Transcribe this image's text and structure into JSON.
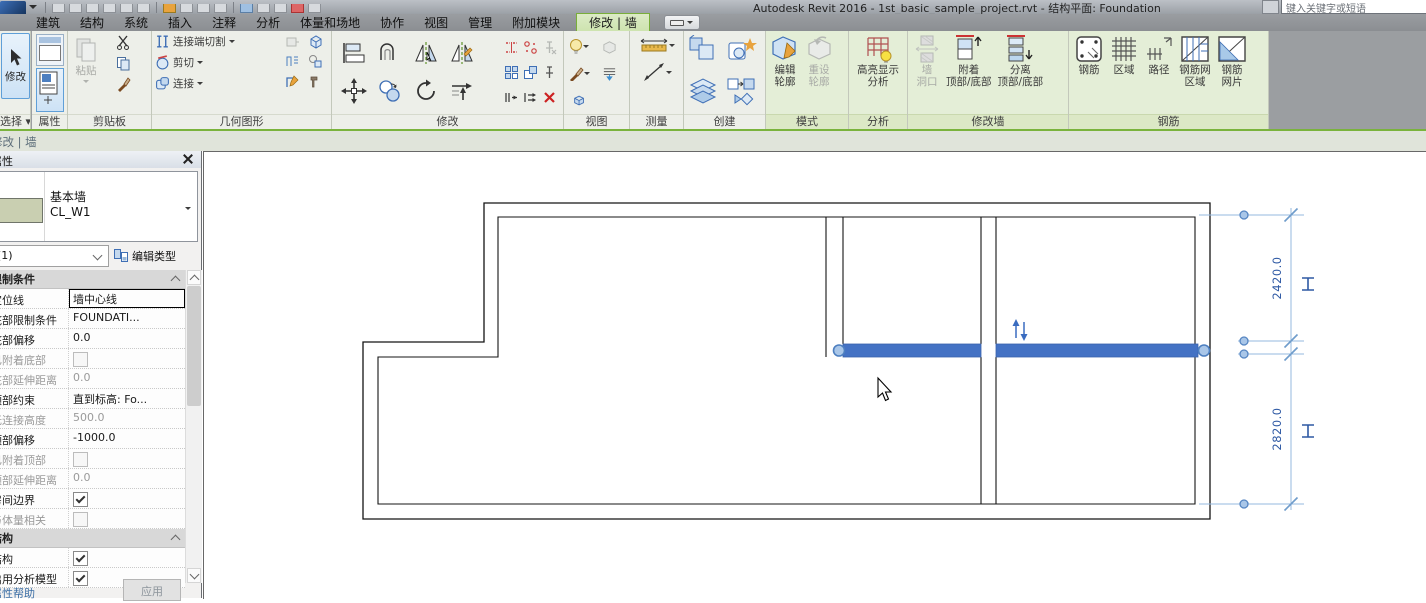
{
  "window": {
    "title": "Autodesk Revit 2016 - 1st_basic_sample_project.rvt - 结构平面: Foundation",
    "search_placeholder": "键入关键字或短语"
  },
  "tabs": {
    "items": [
      "建筑",
      "结构",
      "系统",
      "插入",
      "注释",
      "分析",
      "体量和场地",
      "协作",
      "视图",
      "管理",
      "附加模块"
    ],
    "contextual": "修改 | 墙"
  },
  "ribbon": {
    "panels": {
      "select": {
        "label": "选择",
        "modify": "修改"
      },
      "properties": {
        "label": "属性"
      },
      "clipboard": {
        "label": "剪贴板",
        "paste": "粘贴"
      },
      "geometry": {
        "label": "几何图形",
        "join_cut": "连接端切割",
        "cut": "剪切",
        "join": "连接"
      },
      "modify": {
        "label": "修改"
      },
      "view": {
        "label": "视图"
      },
      "measure": {
        "label": "测量"
      },
      "create": {
        "label": "创建"
      },
      "mode": {
        "label": "模式",
        "edit_profile_1": "编辑",
        "edit_profile_2": "轮廓",
        "reset_profile_1": "重设",
        "reset_profile_2": "轮廓"
      },
      "analysis": {
        "label": "分析",
        "highlight_1": "高亮显示",
        "highlight_2": "分析"
      },
      "modify_wall": {
        "label": "修改墙",
        "opening_1": "墙",
        "opening_2": "洞口",
        "attach_1": "附着",
        "attach_2": "顶部/底部",
        "detach_1": "分离",
        "detach_2": "顶部/底部"
      },
      "rebar": {
        "label": "钢筋",
        "rebar": "钢筋",
        "area": "区域",
        "path": "路径",
        "fabric_area_1": "钢筋网",
        "fabric_area_2": "区域",
        "fabric_sheet_1": "钢筋",
        "fabric_sheet_2": "网片"
      }
    }
  },
  "mode_bar": {
    "text": "修改 | 墙"
  },
  "properties": {
    "header": "属性",
    "type_name": "基本墙",
    "type_code": "CL_W1",
    "selection": "(1)",
    "edit_type": "编辑类型",
    "sections": [
      {
        "title": "限制条件",
        "rows": [
          {
            "label": "定位线",
            "value": "墙中心线",
            "type": "text",
            "enabled": true,
            "active": true
          },
          {
            "label": "底部限制条件",
            "value": "FOUNDATI...",
            "type": "text",
            "enabled": true
          },
          {
            "label": "底部偏移",
            "value": "0.0",
            "type": "text",
            "enabled": true
          },
          {
            "label": "已附着底部",
            "type": "checkbox",
            "checked": false,
            "enabled": false
          },
          {
            "label": "底部延伸距离",
            "value": "0.0",
            "type": "text",
            "enabled": false
          },
          {
            "label": "顶部约束",
            "value": "直到标高: Fo...",
            "type": "text",
            "enabled": true
          },
          {
            "label": "无连接高度",
            "value": "500.0",
            "type": "text",
            "enabled": false
          },
          {
            "label": "顶部偏移",
            "value": "-1000.0",
            "type": "text",
            "enabled": true
          },
          {
            "label": "已附着顶部",
            "type": "checkbox",
            "checked": false,
            "enabled": false
          },
          {
            "label": "顶部延伸距离",
            "value": "0.0",
            "type": "text",
            "enabled": false
          },
          {
            "label": "房间边界",
            "type": "checkbox",
            "checked": true,
            "enabled": true
          },
          {
            "label": "与体量相关",
            "type": "checkbox",
            "checked": false,
            "enabled": false
          }
        ]
      },
      {
        "title": "结构",
        "rows": [
          {
            "label": "结构",
            "type": "checkbox",
            "checked": true,
            "enabled": true
          },
          {
            "label": "启用分析模型",
            "type": "checkbox",
            "checked": true,
            "enabled": true
          }
        ]
      }
    ],
    "help_link": "属性帮助",
    "apply_button": "应用"
  },
  "canvas": {
    "dimensions": [
      "2420.0",
      "2820.0"
    ]
  },
  "colors": {
    "selected_wall": "#4472c4",
    "dimension_blue": "#2e59a4",
    "contextual_tab": "#cde3ae",
    "ribbon_green": "#e4eed7"
  }
}
